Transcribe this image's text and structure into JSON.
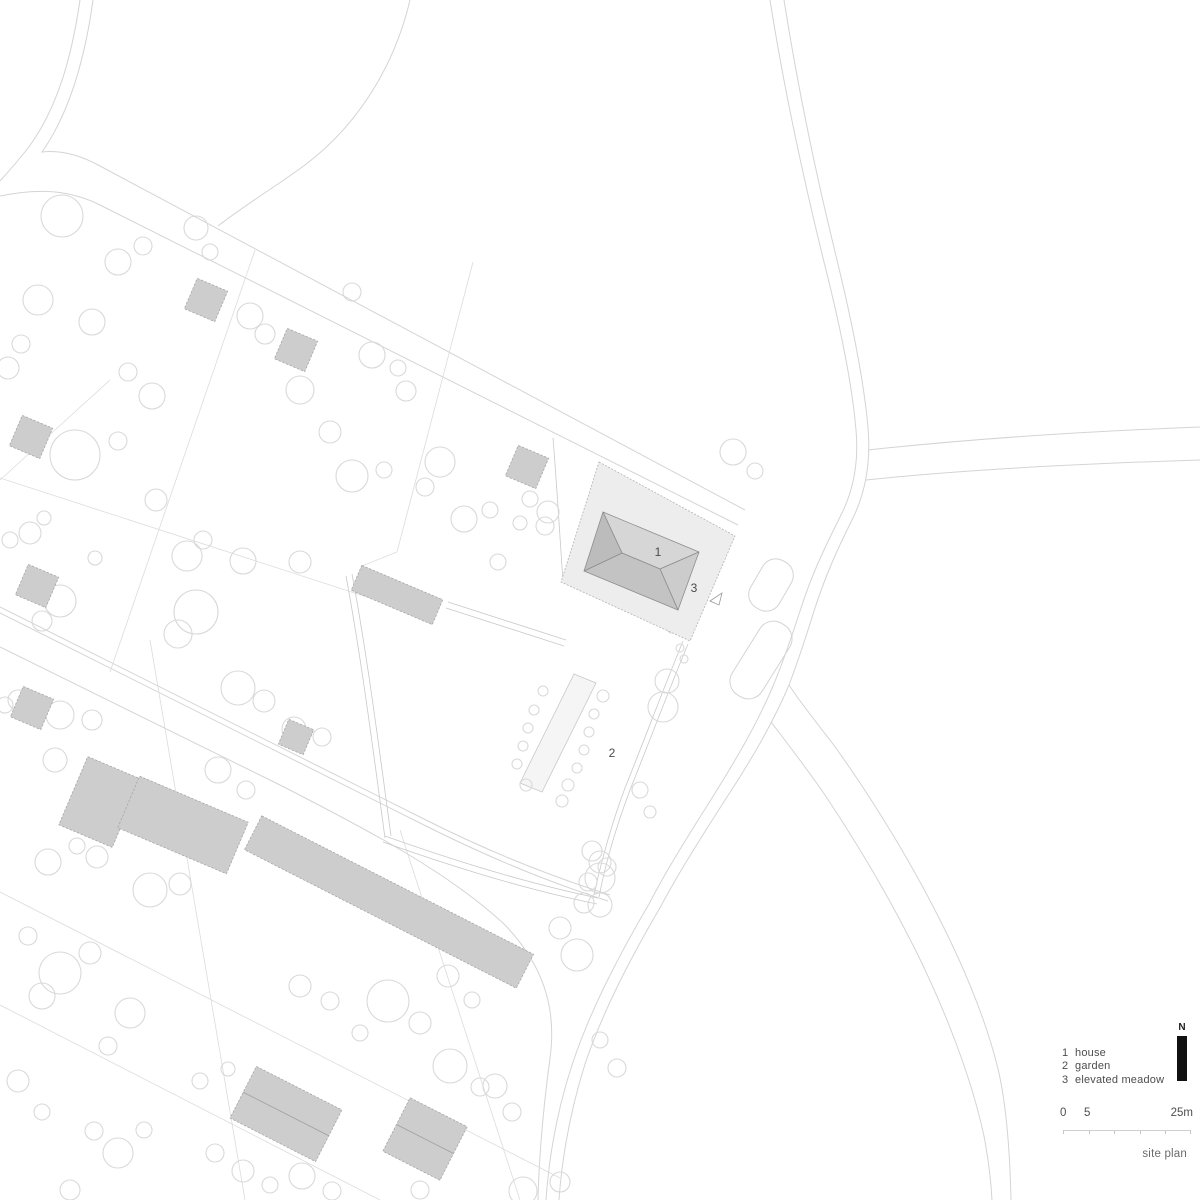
{
  "plan_labels": {
    "house_num": "1",
    "garden_num": "2",
    "meadow_num": "3"
  },
  "legend": {
    "items": [
      {
        "num": "1",
        "label": "house"
      },
      {
        "num": "2",
        "label": "garden"
      },
      {
        "num": "3",
        "label": "elevated meadow"
      }
    ]
  },
  "north_indicator": {
    "label": "N"
  },
  "scale_bar": {
    "zero": "0",
    "five": "5",
    "end": "25m"
  },
  "caption": "site plan",
  "colors": {
    "background": "#ffffff",
    "road_stroke": "#d4d4d4",
    "parcel_stroke": "#dcdcdc",
    "tree_stroke": "#d9d9d9",
    "building_fill": "#cdcdcd",
    "meadow_fill": "#ededed",
    "roof_light": "#d6d6d6",
    "roof_dark": "#c3c3c3",
    "text": "#4d4d4d",
    "north_bar": "#111111"
  }
}
